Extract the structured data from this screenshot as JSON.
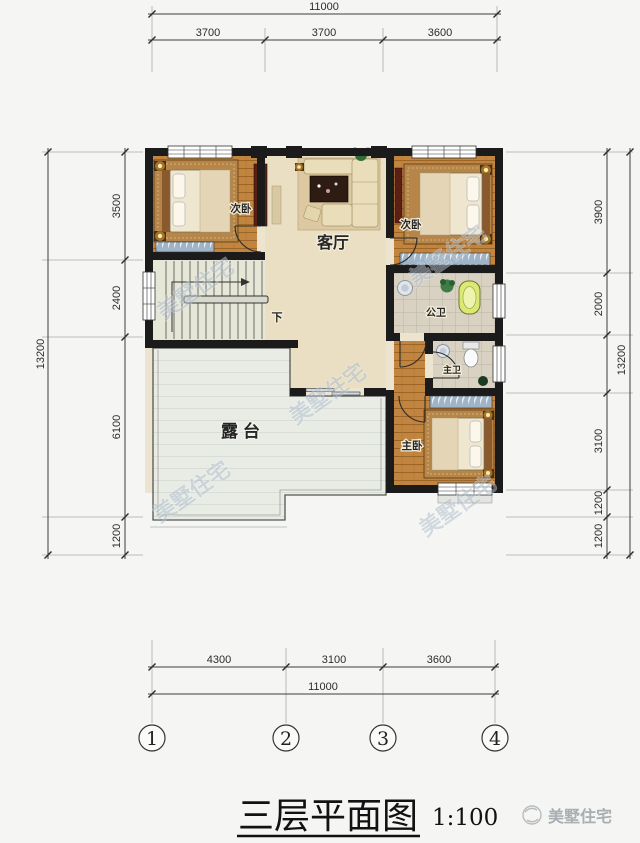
{
  "plan": {
    "title": {
      "text": "三层平面图",
      "scale": "1:100"
    },
    "brand": {
      "name": "美墅住宅"
    },
    "watermark": "美墅住宅",
    "rooms": {
      "bedroom_left": "次卧",
      "bedroom_right": "次卧",
      "living": "客厅",
      "bath_public": "公卫",
      "bath_master": "主卫",
      "bedroom_master": "主卧",
      "terrace": "露台",
      "stairs_down": "下"
    },
    "dims": {
      "top": {
        "overall": "11000",
        "segments": [
          "3700",
          "3700",
          "3600"
        ]
      },
      "bottom": {
        "overall": "11000",
        "segments": [
          "4300",
          "3100",
          "3600"
        ]
      },
      "left": {
        "overall": "13200",
        "segments": [
          "3500",
          "2400",
          "6100",
          "1200"
        ]
      },
      "right": {
        "overall": "13200",
        "segments": [
          "3900",
          "2000",
          "3100",
          "1200",
          "1200"
        ]
      }
    },
    "grid": [
      "1",
      "2",
      "3",
      "4"
    ],
    "colors": {
      "wall": "#1b1b1b",
      "wood_floor": "#c28540",
      "living_floor": "#eadfc2",
      "tile_floor": "#d9d2c3",
      "terrace_floor": "#e9ece5",
      "lamp_glow": "#f7b733",
      "tub": "#dce874"
    }
  }
}
